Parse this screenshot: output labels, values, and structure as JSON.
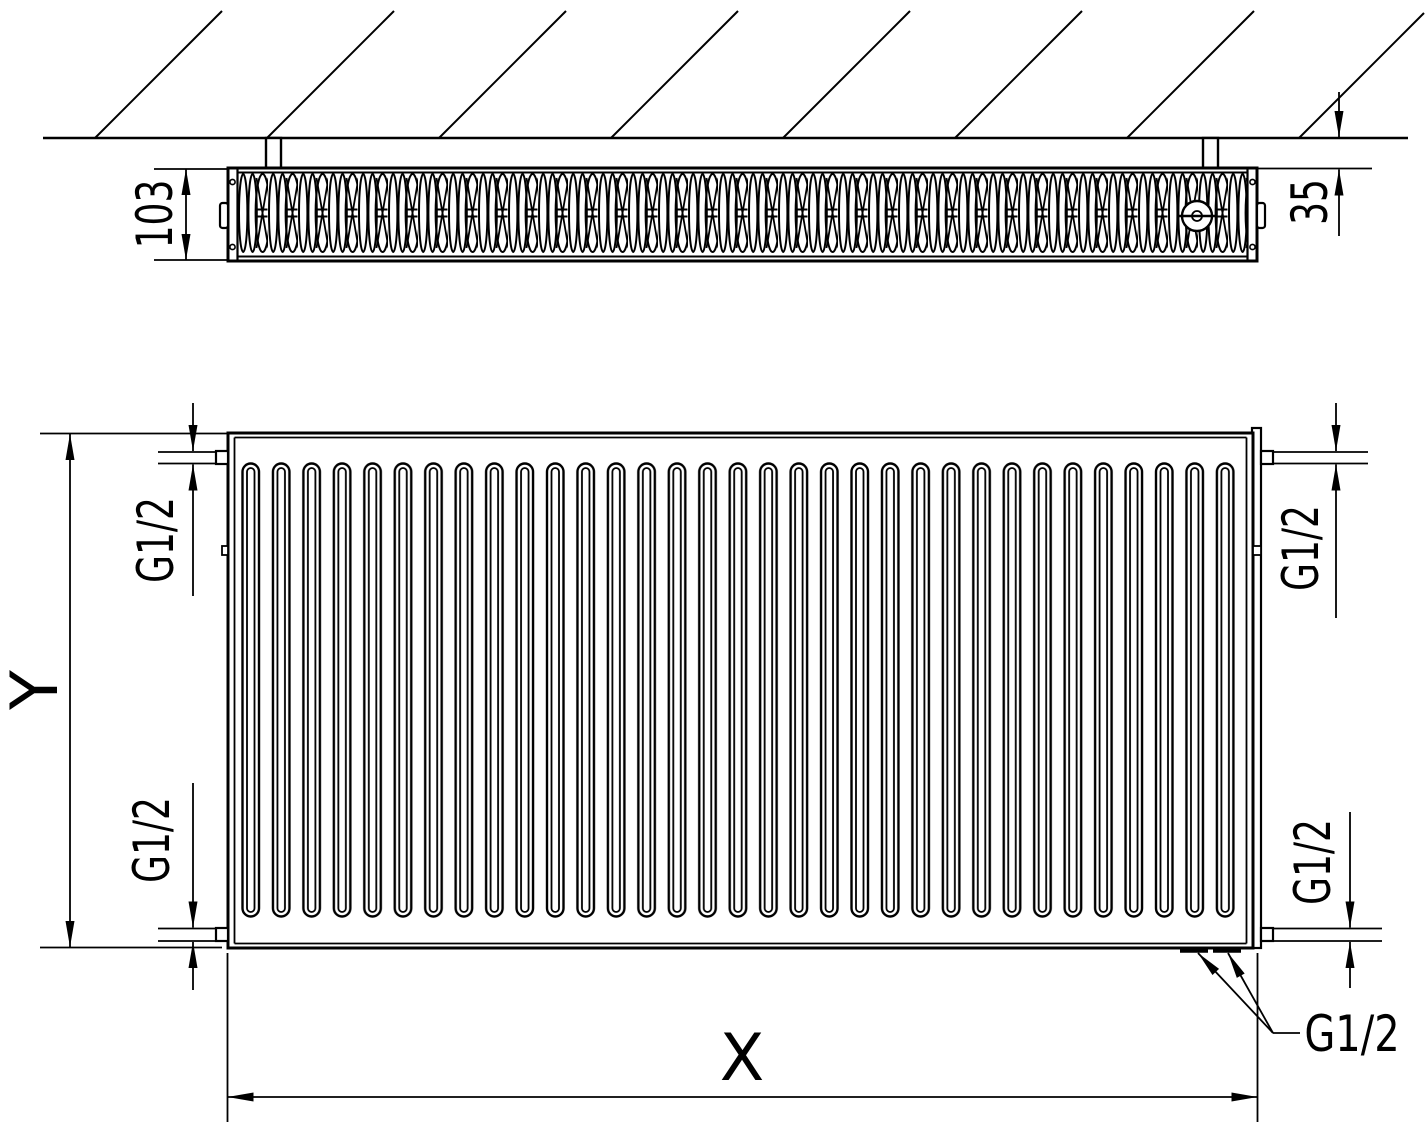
{
  "drawing": {
    "background": "#ffffff",
    "line_color": "#000000",
    "labels": {
      "depth": "103",
      "wall_clearance": "35",
      "height": "Y",
      "width": "X",
      "thread_top_left": "G1/2",
      "thread_top_right": "G1/2",
      "thread_bottom_left": "G1/2",
      "thread_bottom_right": "G1/2",
      "thread_callout": "G1/2"
    }
  }
}
